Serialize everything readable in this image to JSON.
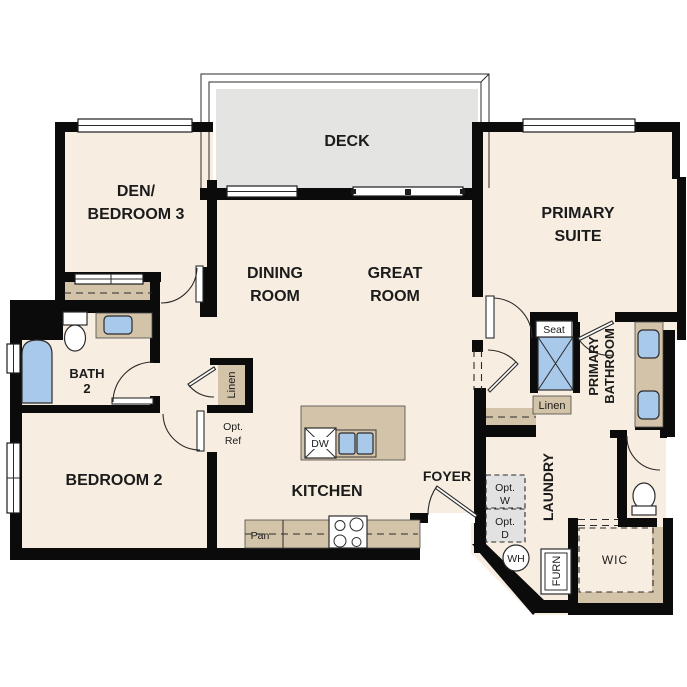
{
  "colors": {
    "floor": "#f7eee1",
    "deck": "#e4e4e2",
    "wall": "#0b0b0b",
    "counter": "#d3c3a8",
    "fixture": "#a9c9ea",
    "optional": "#e2e2e2"
  },
  "rooms": {
    "deck": {
      "label": "DECK"
    },
    "den": {
      "line1": "DEN/",
      "line2": "BEDROOM 3"
    },
    "dining": {
      "line1": "DINING",
      "line2": "ROOM"
    },
    "great": {
      "line1": "GREAT",
      "line2": "ROOM"
    },
    "primary_suite": {
      "line1": "PRIMARY",
      "line2": "SUITE"
    },
    "bath2": {
      "line1": "BATH",
      "line2": "2"
    },
    "bedroom2": {
      "label": "BEDROOM 2"
    },
    "kitchen": {
      "label": "KITCHEN"
    },
    "foyer": {
      "label": "FOYER"
    },
    "laundry": {
      "label": "LAUNDRY"
    },
    "primary_bath": {
      "line1": "PRIMARY",
      "line2": "BATHROOM"
    },
    "wic": {
      "label": "WIC"
    }
  },
  "features": {
    "seat": "Seat",
    "linen_hall": "Linen",
    "linen_laundry": "Linen",
    "opt_ref": {
      "line1": "Opt.",
      "line2": "Ref"
    },
    "opt_washer": {
      "line1": "Opt.",
      "line2": "W"
    },
    "opt_dryer": {
      "line1": "Opt.",
      "line2": "D"
    },
    "water_heater": "WH",
    "furnace": "FURN",
    "pantry": "Pan",
    "dishwasher": "DW"
  }
}
